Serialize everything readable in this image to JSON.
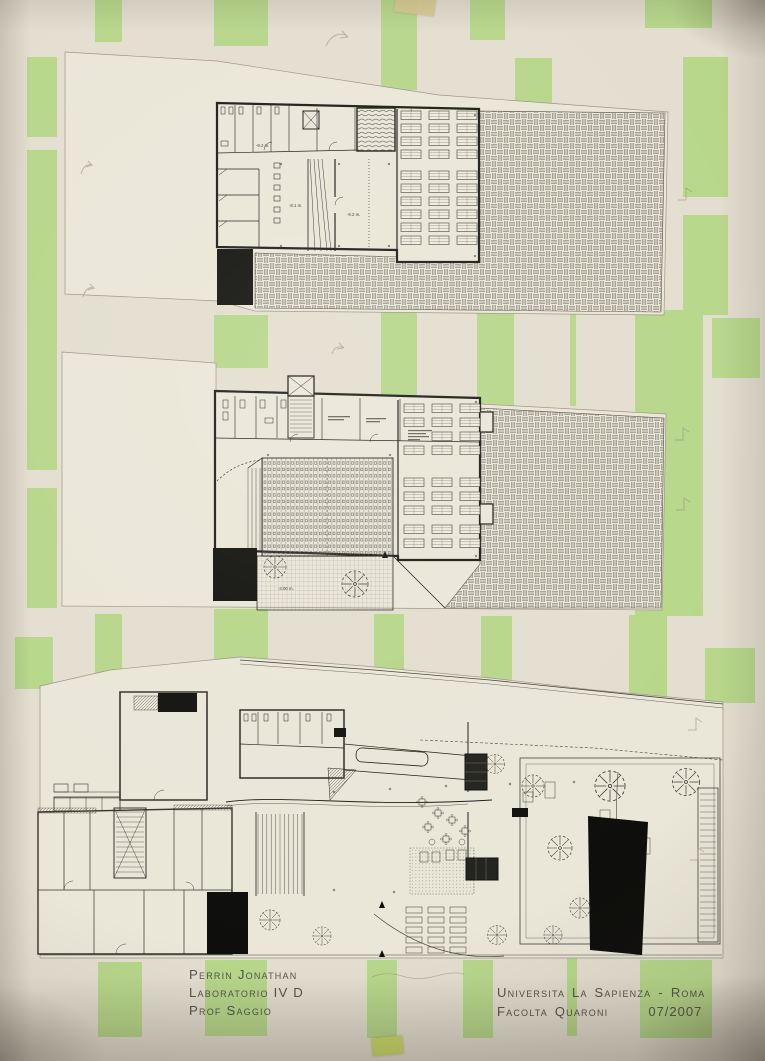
{
  "poster": {
    "credits_left": {
      "author": "Perrin Jonathan",
      "course": "Laboratorio IV D",
      "professor": "Prof Saggio"
    },
    "credits_right": {
      "institution": "Universita La Sapienza",
      "separator": "-",
      "city": "Roma",
      "faculty": "Facolta Quaroni",
      "date": "07/2007"
    }
  },
  "plans": {
    "upper_plan": {
      "labels": {
        "corridor_level": "-9.2 m.",
        "hall_left_level": "-8.1 m.",
        "hall_right_level": "-9.2 m."
      }
    },
    "middle_plan": {
      "labels": {
        "courtyard_level": "-3.00 m."
      }
    }
  },
  "colors": {
    "paper": "#e3decf",
    "sheet": "#eae6d8",
    "stripe_green": "#b7d78a",
    "ink": "#1d1d1a",
    "line": "#45423b",
    "tape_beige": "#d7ca92",
    "tape_green": "#cbdc68"
  }
}
